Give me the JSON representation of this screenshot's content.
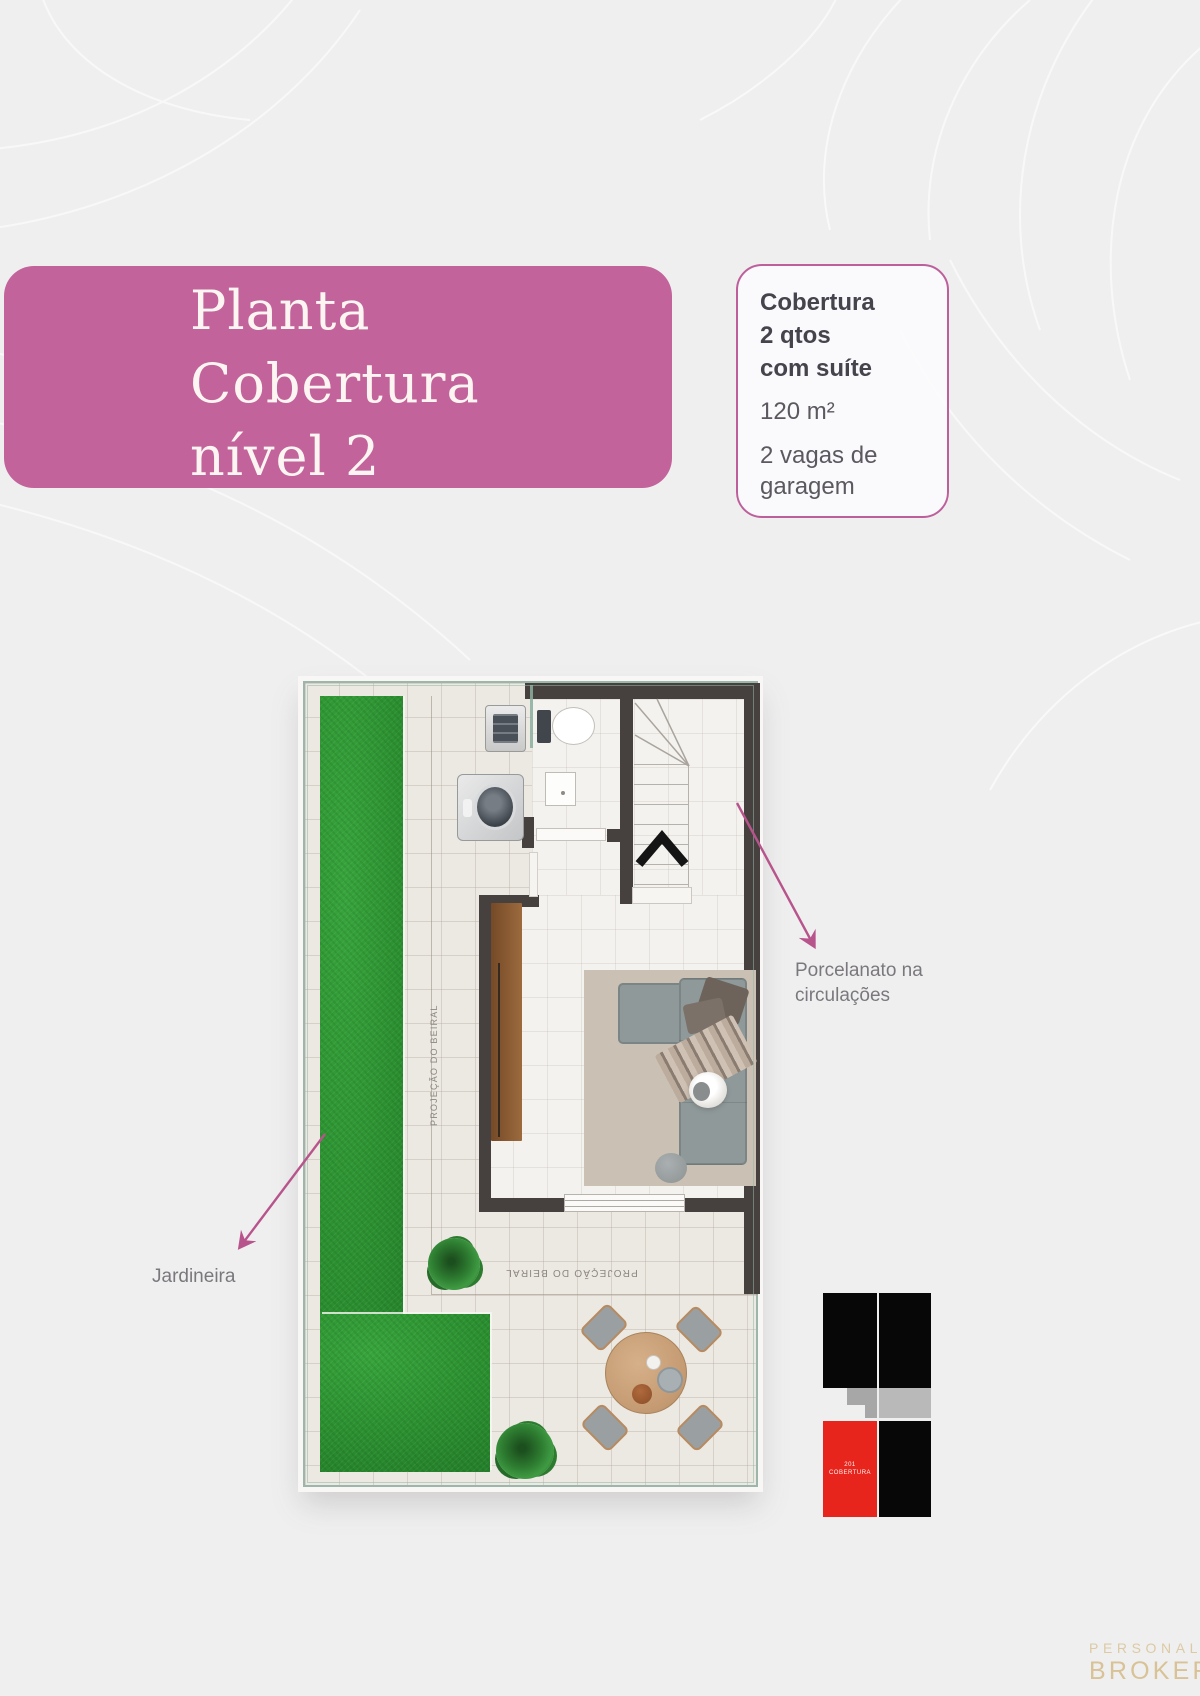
{
  "title_box": {
    "lines": [
      "Planta",
      "Cobertura",
      "nível 2"
    ]
  },
  "spec_card": {
    "name_lines": [
      "Cobertura",
      "2 qtos",
      "com suíte"
    ],
    "area": "120 m²",
    "garage": "2 vagas de garagem"
  },
  "callouts": {
    "porcelanato": {
      "line1": "Porcelanato na",
      "line2": "circulações"
    },
    "jardineira": {
      "label": "Jardineira"
    }
  },
  "plan": {
    "beiral_left": "PROJEÇÃO DO BEIRAL",
    "beiral_bottom": "PROJEÇÃO DO BEIRAL"
  },
  "stack_diagram": {
    "unit_number": "201",
    "unit_type": "COBERTURA"
  },
  "brand": {
    "top": "PERSONAL",
    "bottom": "BROKER"
  },
  "colors": {
    "accent_pink": "#c2639b",
    "card_border": "#bd5f9b",
    "arrow_pink": "#b8548c",
    "grass_green": "#2b9030",
    "wall_dark": "#46403e",
    "unit_red": "#e8251d",
    "brand_gold": "#d8c296"
  }
}
